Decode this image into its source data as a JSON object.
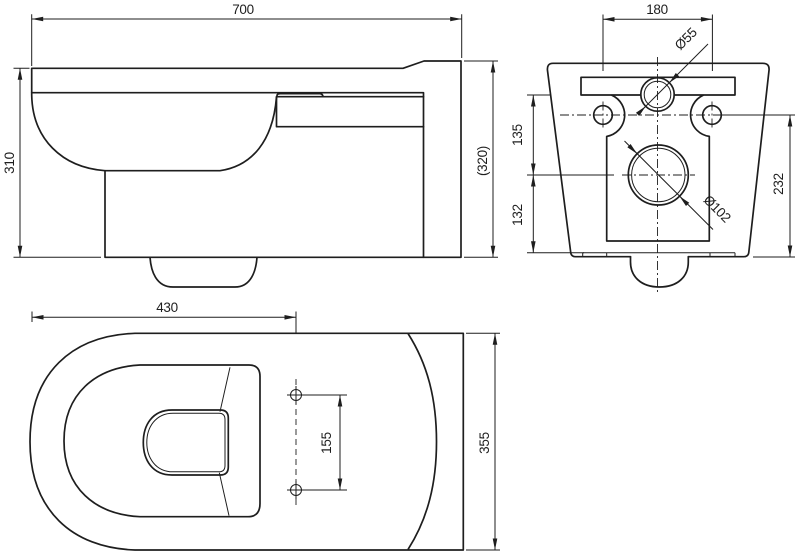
{
  "drawing": {
    "background": "#ffffff",
    "ink": "#1e1e1e",
    "side_view": {
      "dims": {
        "overall_length": "700",
        "height_front": "310",
        "height_back": "(320)"
      }
    },
    "rear_view": {
      "dims": {
        "mount_hole_spacing": "180",
        "inlet_diameter": "Ø55",
        "inlet_to_outlet": "135",
        "outlet_to_bottom": "132",
        "outlet_diameter": "Ø102",
        "holes_to_bottom": "232"
      }
    },
    "top_view": {
      "dims": {
        "front_to_seat_holes": "430",
        "seat_hole_spacing": "155",
        "overall_width": "355"
      }
    }
  }
}
